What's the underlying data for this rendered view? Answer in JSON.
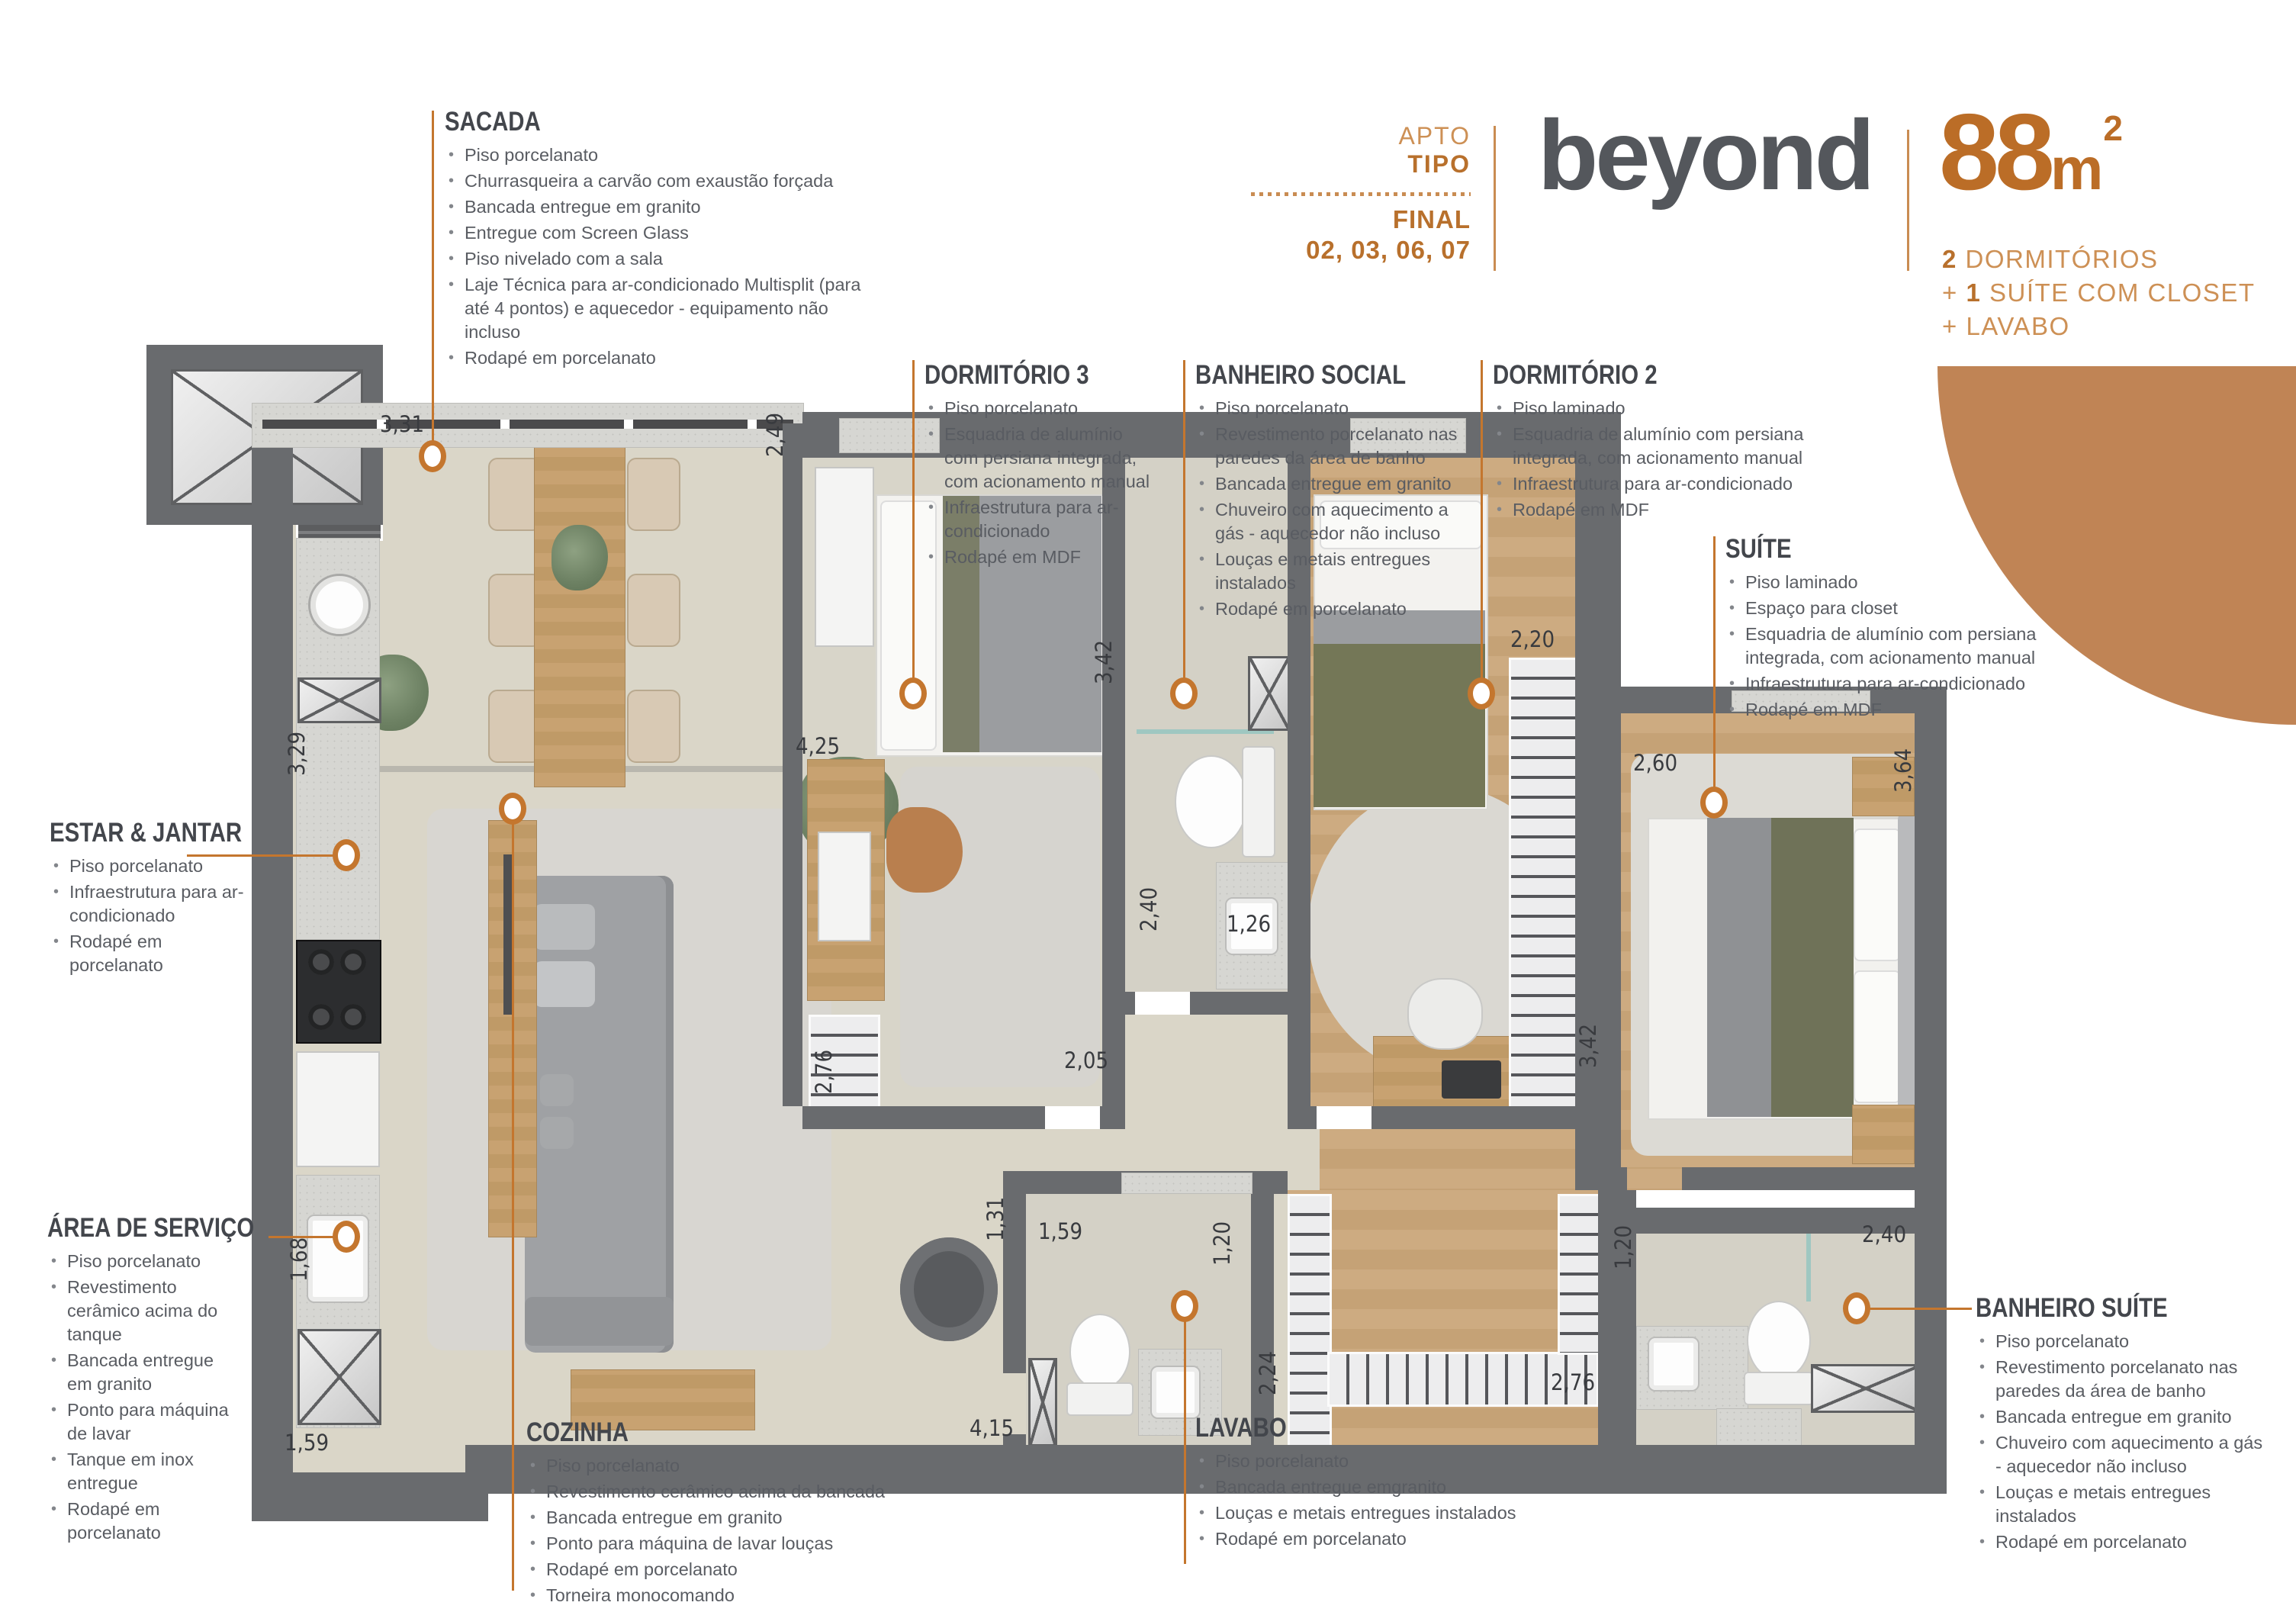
{
  "accent_color": "#c4762e",
  "arc_color": "#c08455",
  "header": {
    "apto": "APTO",
    "tipo": "TIPO",
    "final": "FINAL",
    "final_values": "02, 03, 06, 07",
    "brand": "beyond",
    "area_value": "88",
    "area_unit": "m",
    "area_sup": "2",
    "features": [
      {
        "pre": "",
        "strong": "2",
        "rest": " DORMITÓRIOS"
      },
      {
        "pre": "+ ",
        "strong": "1",
        "rest": " SUÍTE COM CLOSET"
      },
      {
        "pre": "+ ",
        "strong": "",
        "rest": "LAVABO"
      }
    ]
  },
  "sections": {
    "sacada": {
      "title": "SACADA",
      "items": [
        "Piso porcelanato",
        "Churrasqueira a carvão com exaustão forçada",
        "Bancada entregue em granito",
        "Entregue com Screen Glass",
        "Piso nivelado com a sala",
        "Laje Técnica para ar-condicionado Multisplit (para até 4 pontos) e aquecedor - equipamento não incluso",
        "Rodapé em porcelanato"
      ]
    },
    "dormitorio3": {
      "title": "DORMITÓRIO 3",
      "items": [
        "Piso porcelanato",
        "Esquadria de alumínio com persiana integrada, com acionamento manual",
        "Infraestrutura para ar-condicionado",
        "Rodapé em MDF"
      ]
    },
    "banheiro_social": {
      "title": "BANHEIRO SOCIAL",
      "items": [
        "Piso porcelanato",
        "Revestimento porcelanato nas paredes da área de banho",
        "Bancada entregue em granito",
        "Chuveiro com aquecimento a gás - aquecedor não incluso",
        "Louças e metais entregues instalados",
        "Rodapé em porcelanato"
      ]
    },
    "dormitorio2": {
      "title": "DORMITÓRIO 2",
      "items": [
        "Piso laminado",
        "Esquadria de alumínio com persiana integrada, com acionamento manual",
        "Infraestrutura para ar-condicionado",
        "Rodapé em MDF"
      ]
    },
    "suite": {
      "title": "SUÍTE",
      "items": [
        "Piso laminado",
        "Espaço para closet",
        "Esquadria de alumínio com persiana integrada, com acionamento manual",
        "Infraestrutura para ar-condicionado",
        "Rodapé em MDF"
      ]
    },
    "estar_jantar": {
      "title": "ESTAR & JANTAR",
      "items": [
        "Piso porcelanato",
        "Infraestrutura para ar-condicionado",
        "Rodapé em porcelanato"
      ]
    },
    "area_servico": {
      "title": "ÁREA DE SERVIÇO",
      "items": [
        "Piso porcelanato",
        "Revestimento cerâmico acima do tanque",
        "Bancada entregue em granito",
        "Ponto para máquina de lavar",
        "Tanque em inox entregue",
        "Rodapé em porcelanato"
      ]
    },
    "cozinha": {
      "title": "COZINHA",
      "items": [
        "Piso porcelanato",
        "Revestimento cerâmico acima da bancada",
        "Bancada entregue em granito",
        "Ponto para máquina de lavar louças",
        "Rodapé em porcelanato",
        "Torneira monocomando"
      ]
    },
    "lavabo": {
      "title": "LAVABO",
      "items": [
        "Piso porcelanato",
        "Bancada entregue emgranito",
        "Louças e metais entregues instalados",
        "Rodapé em porcelanato"
      ]
    },
    "banheiro_suite": {
      "title": "BANHEIRO SUÍTE",
      "items": [
        "Piso porcelanato",
        "Revestimento porcelanato nas paredes da área de banho",
        "Bancada entregue em granito",
        "Chuveiro com aquecimento a gás - aquecedor não incluso",
        "Louças e metais entregues instalados",
        "Rodapé em porcelanato"
      ]
    }
  },
  "dims": [
    "3,31",
    "2,49",
    "3,29",
    "4,25",
    "3,42",
    "2,20",
    "2,60",
    "3,64",
    "2,40",
    "1,26",
    "2,05",
    "2,76",
    "3,42",
    "1,31",
    "1,59",
    "1,20",
    "2,24",
    "4,15",
    "2,76",
    "1,20",
    "2,40",
    "1,68",
    "1,59"
  ]
}
